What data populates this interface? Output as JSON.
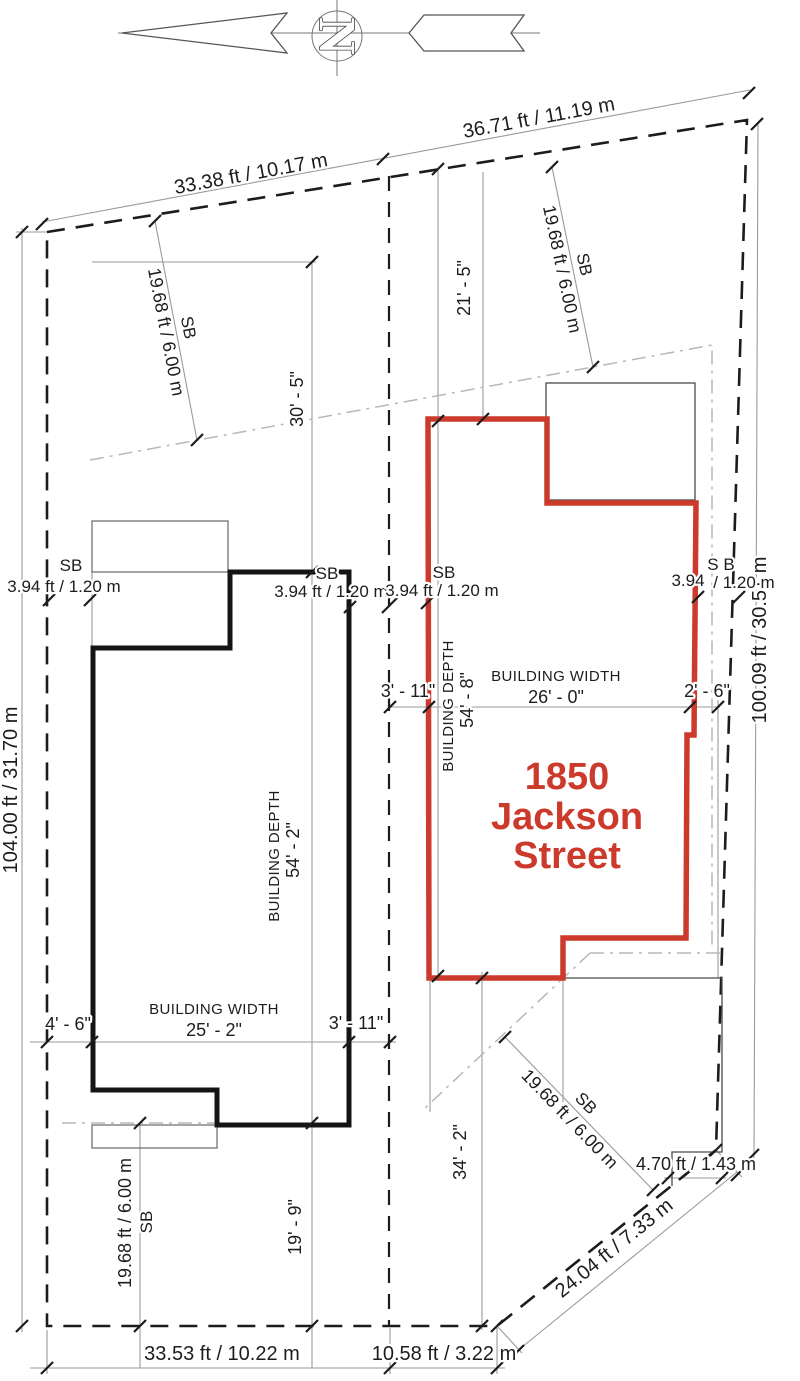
{
  "title": "Site plan - 1850 Jackson Street",
  "north": {
    "letter": "N"
  },
  "address": {
    "line1": "1850",
    "line2": "Jackson",
    "line3": "Street"
  },
  "colors": {
    "accent_red": "#cc3a2c",
    "line_black": "#1c1c1c",
    "line_gray": "#9a9a9a",
    "setback_gray": "#b7b7b7"
  },
  "lot_dims": {
    "top_left": "33.38 ft / 10.17 m",
    "top_right": "36.71 ft / 11.19 m",
    "left": "104.00 ft / 31.70 m",
    "right": "100.09 ft / 30.51 m",
    "bottom_left": "33.53 ft / 10.22 m",
    "bottom_mid": "10.58 ft / 3.22 m",
    "corner": "24.04 ft / 7.33 m",
    "corner_offset": "4.70 ft / 1.43 m"
  },
  "setbacks": {
    "sb_label": "SB",
    "sb_label_spaced": "S B",
    "front_left_value": "19.68 ft / 6.00 m",
    "front_right_value": "19.68 ft / 6.00 m",
    "rear_left_value": "19.68 ft / 6.00 m",
    "rear_right_value": "19.68 ft / 6.00 m",
    "side_left_value": "3.94 ft / 1.20 m",
    "side_mid_left_value": "3.94 ft / 1.20 m",
    "side_mid_right_value": "3.94 ft / 1.20 m",
    "side_right_value_a": "3.94",
    "side_right_value_b": "/ 1.20 m"
  },
  "building_left": {
    "depth_label": "BUILDING DEPTH",
    "depth_value": "54' - 2\"",
    "width_label": "BUILDING WIDTH",
    "width_value": "25' - 2\"",
    "front_offset": "30' - 5\"",
    "rear_offset": "19' - 9\"",
    "side_offset_left": "4' - 6\"",
    "side_offset_right": "3' - 11\""
  },
  "building_right": {
    "depth_label": "BUILDING DEPTH",
    "depth_value": "54' - 8\"",
    "width_label": "BUILDING WIDTH",
    "width_value": "26' - 0\"",
    "front_offset": "21' - 5\"",
    "rear_offset": "34' - 2\"",
    "side_offset_left": "3' - 11\"",
    "side_offset_right": "2' - 6\""
  }
}
